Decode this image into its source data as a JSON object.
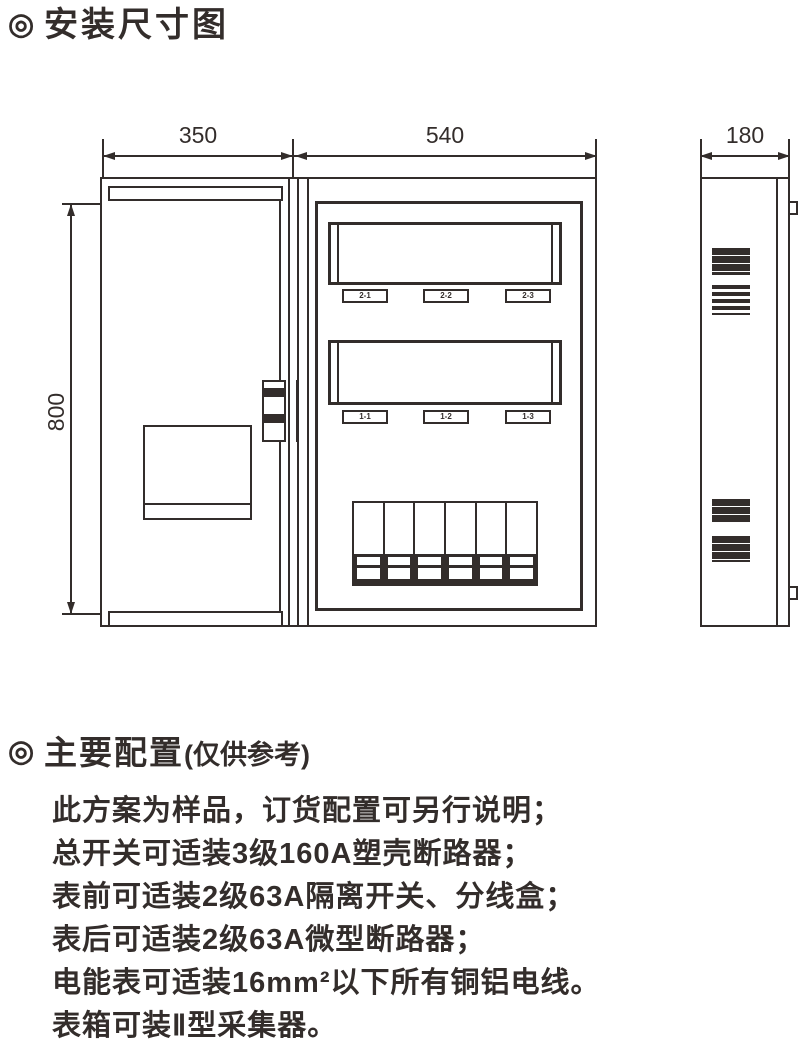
{
  "ink": "#332d2b",
  "title": {
    "bullet": "◎",
    "text": "安装尺寸图"
  },
  "drawing": {
    "dims": {
      "door_width": "350",
      "box_width": "540",
      "side_width": "180",
      "height": "800"
    },
    "meter_labels_row2": [
      "2-1",
      "2-2",
      "2-3"
    ],
    "meter_labels_row1": [
      "1-1",
      "1-2",
      "1-3"
    ]
  },
  "config": {
    "bullet": "◎",
    "heading": "主要配置",
    "heading_note": "(仅供参考)",
    "lines": [
      "此方案为样品，订货配置可另行说明；",
      "总开关可适装3级160A塑壳断路器；",
      "表前可适装2级63A隔离开关、分线盒；",
      "表后可适装2级63A微型断路器；",
      "电能表可适装16mm²以下所有铜铝电线。",
      "表箱可装Ⅱ型采集器。"
    ]
  }
}
